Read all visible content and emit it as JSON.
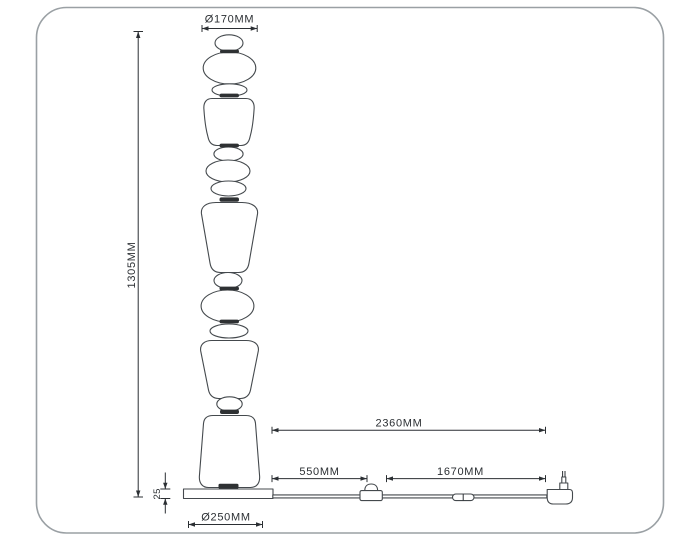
{
  "labels": {
    "top_diameter": "Ø170MM",
    "total_height": "1305MM",
    "base_thickness": "25",
    "base_diameter": "Ø250MM",
    "cord_total_length": "2360MM",
    "cord_base_to_switch": "550MM",
    "cord_switch_to_plug": "1670MM"
  },
  "colors": {
    "outline": "#44494d",
    "dimension": "#2b2f33",
    "joint_fill": "#2e3133",
    "frame_border": "#9aa0a4",
    "background": "#ffffff"
  }
}
